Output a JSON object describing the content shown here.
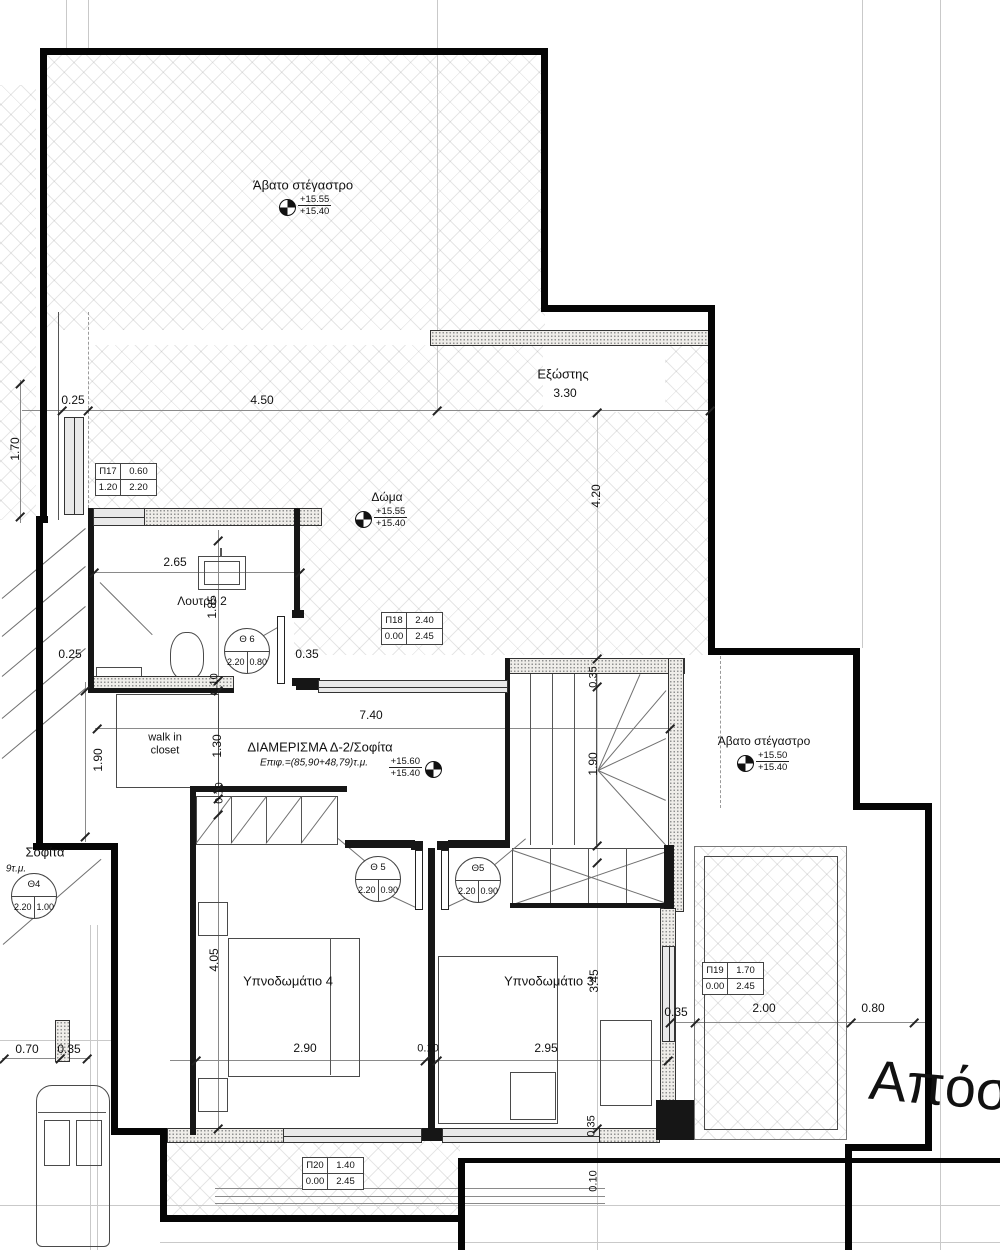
{
  "plan_title": "ΔΙΑΜΕΡΙΣΜΑ Δ-2/Σοφίτα",
  "texts": [
    {
      "name": "label-avato-top",
      "t": "Άβατο στέγαστρο",
      "x": 303,
      "y": 186,
      "s": 13
    },
    {
      "name": "label-exostis",
      "t": "Εξώστης",
      "x": 563,
      "y": 375,
      "s": 13
    },
    {
      "name": "label-doma",
      "t": "Δώμα",
      "x": 387,
      "y": 498,
      "s": 12
    },
    {
      "name": "label-loutro",
      "t": "Λουτρό 2",
      "x": 202,
      "y": 602,
      "s": 12
    },
    {
      "name": "label-walkin-closet",
      "t": "walk in\ncloset",
      "x": 165,
      "y": 744,
      "s": 11
    },
    {
      "name": "label-apartment-title",
      "t": "ΔΙΑΜΕΡΙΣΜΑ Δ-2/Σοφίτα",
      "x": 320,
      "y": 748,
      "s": 13
    },
    {
      "name": "label-apartment-area",
      "t": "Επιφ.=(85,90+48,79)τ.μ.",
      "x": 314,
      "y": 763,
      "s": 10,
      "i": 1
    },
    {
      "name": "label-bedroom4",
      "t": "Υπνοδωμάτιο 4",
      "x": 288,
      "y": 982,
      "s": 13
    },
    {
      "name": "label-bedroom3",
      "t": "Υπνοδωμάτιο 3",
      "x": 549,
      "y": 982,
      "s": 13
    },
    {
      "name": "label-avato-right",
      "t": "Άβατο στέγαστρο",
      "x": 764,
      "y": 742,
      "s": 12
    },
    {
      "name": "label-sofita-fragment",
      "t": "Σοφίτα",
      "x": 45,
      "y": 853,
      "s": 13
    },
    {
      "name": "label-area-fragment",
      "t": "9τ.μ.",
      "x": 16,
      "y": 869,
      "s": 10,
      "i": 1
    },
    {
      "name": "label-apostasi",
      "t": "Απόσ",
      "x": 940,
      "y": 1086,
      "s": 56,
      "r": 5
    },
    {
      "name": "dim",
      "t": "0.25",
      "x": 73,
      "y": 401,
      "s": 12
    },
    {
      "name": "dim",
      "t": "4.50",
      "x": 262,
      "y": 401,
      "s": 12
    },
    {
      "name": "dim",
      "t": "3.30",
      "x": 565,
      "y": 394,
      "s": 12
    },
    {
      "name": "dim",
      "t": "1.70",
      "x": 16,
      "y": 449,
      "s": 12,
      "r": -90
    },
    {
      "name": "dim",
      "t": "4.20",
      "x": 597,
      "y": 496,
      "s": 12,
      "r": -90
    },
    {
      "name": "dim",
      "t": "2.65",
      "x": 175,
      "y": 563,
      "s": 12
    },
    {
      "name": "dim",
      "t": "1.85",
      "x": 213,
      "y": 607,
      "s": 12,
      "r": -90
    },
    {
      "name": "dim",
      "t": "0.35",
      "x": 307,
      "y": 655,
      "s": 12
    },
    {
      "name": "dim",
      "t": "0.25",
      "x": 70,
      "y": 655,
      "s": 12
    },
    {
      "name": "dim",
      "t": "0.10",
      "x": 215,
      "y": 684,
      "s": 11,
      "r": -90
    },
    {
      "name": "dim",
      "t": "1.90",
      "x": 99,
      "y": 760,
      "s": 12,
      "r": -90
    },
    {
      "name": "dim",
      "t": "1.30",
      "x": 218,
      "y": 746,
      "s": 12,
      "r": -90
    },
    {
      "name": "dim",
      "t": "0.10",
      "x": 220,
      "y": 793,
      "s": 11,
      "r": -90
    },
    {
      "name": "dim",
      "t": "7.40",
      "x": 371,
      "y": 716,
      "s": 12
    },
    {
      "name": "dim",
      "t": "0.35",
      "x": 594,
      "y": 677,
      "s": 11,
      "r": -90
    },
    {
      "name": "dim",
      "t": "1.90",
      "x": 594,
      "y": 764,
      "s": 12,
      "r": -90
    },
    {
      "name": "dim",
      "t": "4.05",
      "x": 215,
      "y": 960,
      "s": 12,
      "r": -90
    },
    {
      "name": "dim",
      "t": "3.45",
      "x": 595,
      "y": 981,
      "s": 12,
      "r": -90
    },
    {
      "name": "dim",
      "t": "2.90",
      "x": 305,
      "y": 1049,
      "s": 12
    },
    {
      "name": "dim",
      "t": "0.10",
      "x": 428,
      "y": 1049,
      "s": 11
    },
    {
      "name": "dim",
      "t": "2.95",
      "x": 546,
      "y": 1049,
      "s": 12
    },
    {
      "name": "dim",
      "t": "0.35",
      "x": 676,
      "y": 1013,
      "s": 12
    },
    {
      "name": "dim",
      "t": "2.00",
      "x": 764,
      "y": 1009,
      "s": 12
    },
    {
      "name": "dim",
      "t": "0.80",
      "x": 873,
      "y": 1009,
      "s": 12
    },
    {
      "name": "dim",
      "t": "0.70",
      "x": 27,
      "y": 1050,
      "s": 12
    },
    {
      "name": "dim",
      "t": "0.35",
      "x": 69,
      "y": 1050,
      "s": 12
    },
    {
      "name": "dim",
      "t": "0.35",
      "x": 592,
      "y": 1126,
      "s": 11,
      "r": -90
    },
    {
      "name": "dim",
      "t": "0.10",
      "x": 594,
      "y": 1181,
      "s": 11,
      "r": -90
    }
  ],
  "ticks": [
    [
      62,
      410
    ],
    [
      88,
      410
    ],
    [
      437,
      410
    ],
    [
      710,
      410
    ],
    [
      20,
      383
    ],
    [
      20,
      516
    ],
    [
      94,
      572
    ],
    [
      300,
      572
    ],
    [
      97,
      728
    ],
    [
      670,
      728
    ],
    [
      85,
      690
    ],
    [
      85,
      836
    ],
    [
      218,
      540
    ],
    [
      218,
      680
    ],
    [
      218,
      690
    ],
    [
      218,
      788
    ],
    [
      218,
      798
    ],
    [
      218,
      814
    ],
    [
      218,
      1128
    ],
    [
      196,
      1060
    ],
    [
      425,
      1060
    ],
    [
      437,
      1060
    ],
    [
      668,
      1060
    ],
    [
      670,
      1022
    ],
    [
      695,
      1022
    ],
    [
      851,
      1022
    ],
    [
      914,
      1022
    ],
    [
      4,
      1058
    ],
    [
      60,
      1058
    ],
    [
      87,
      1058
    ],
    [
      597,
      412
    ],
    [
      597,
      658
    ],
    [
      597,
      686
    ],
    [
      597,
      845
    ],
    [
      597,
      862
    ],
    [
      597,
      1128
    ]
  ],
  "pi_tags": [
    {
      "name": "window-tag-p17",
      "x": 95,
      "y": 463,
      "id": "Π17",
      "v1": "0.60",
      "v2": "1.20",
      "v3": "2.20"
    },
    {
      "name": "window-tag-p18",
      "x": 381,
      "y": 612,
      "id": "Π18",
      "v1": "2.40",
      "v2": "0.00",
      "v3": "2.45"
    },
    {
      "name": "window-tag-p19",
      "x": 702,
      "y": 962,
      "id": "Π19",
      "v1": "1.70",
      "v2": "0.00",
      "v3": "2.45"
    },
    {
      "name": "window-tag-p20",
      "x": 302,
      "y": 1157,
      "id": "Π20",
      "v1": "1.40",
      "v2": "0.00",
      "v3": "2.45"
    }
  ],
  "theta_tags": [
    {
      "name": "door-tag-th6",
      "cx": 246,
      "cy": 650,
      "label": "Θ 6",
      "v1": "2.20",
      "v2": "0.80"
    },
    {
      "name": "door-tag-th5a",
      "cx": 377,
      "cy": 878,
      "label": "Θ 5",
      "v1": "2.20",
      "v2": "0.90"
    },
    {
      "name": "door-tag-th5b",
      "cx": 477,
      "cy": 879,
      "label": "Θ5",
      "v1": "2.20",
      "v2": "0.90"
    },
    {
      "name": "door-tag-th4",
      "cx": 33,
      "cy": 895,
      "label": "Θ4",
      "v1": "2.20",
      "v2": "1.00"
    }
  ],
  "elev_markers": [
    {
      "name": "elevation-roof-top",
      "cx": 287,
      "cy": 207,
      "v1": "+15.55",
      "v2": "+15.40",
      "side": "right"
    },
    {
      "name": "elevation-doma",
      "cx": 363,
      "cy": 519,
      "v1": "+15.55",
      "v2": "+15.40",
      "side": "right"
    },
    {
      "name": "elevation-apartment",
      "cx": 433,
      "cy": 769,
      "v1": "+15.60",
      "v2": "+15.40",
      "side": "left"
    },
    {
      "name": "elevation-roof-right",
      "cx": 745,
      "cy": 763,
      "v1": "+15.50",
      "v2": "+15.40",
      "side": "right"
    }
  ],
  "colors": {
    "wall": "#050505",
    "hatch_line": "#6e6e6e",
    "window_fill": "#e9e9e9",
    "dim": "#111111"
  }
}
